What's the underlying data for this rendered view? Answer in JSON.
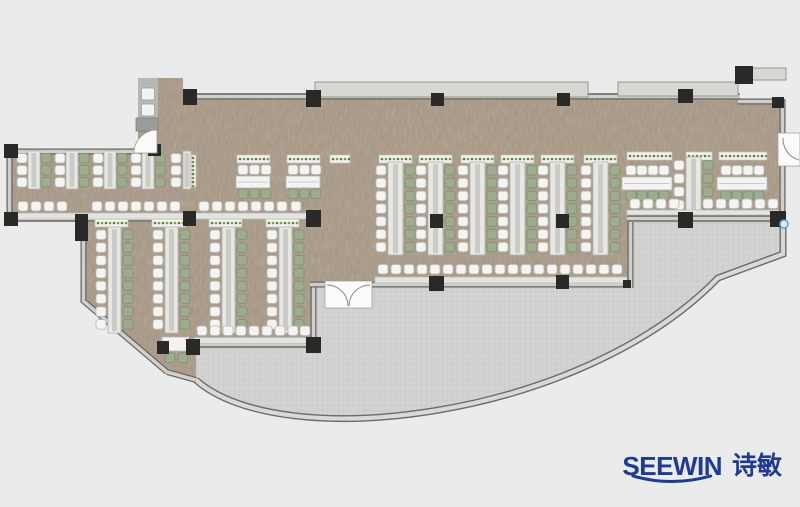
{
  "logo": {
    "brand": "SEEWIN",
    "cjk": "诗敏",
    "color": "#1b3a99"
  },
  "colors": {
    "background": "#ebebeb",
    "floor": "#a99884",
    "terrace": "#d3d3d1",
    "terrace_grid": "#c3c3c1",
    "wall_dark": "#63635f",
    "wall_light": "#cfcfcb",
    "canopy": "#d8d8d3",
    "canopy_edge": "#97978f",
    "column": "#292927",
    "bench": "#e7e7e3",
    "bench_edge": "#b5b5b1",
    "bench_spine": "#cbcbc7",
    "desk": "#f3f3f1",
    "chair_white": "#f4f4f2",
    "chair_white_edge": "#b9b9b5",
    "chair_green": "#9dac8d",
    "chair_green_edge": "#7f9070",
    "planter_bg": "#f1f1ef",
    "planter_edge": "#c2c2be",
    "planter_dot": "#5f7d37",
    "planter_dot2": "#7a9a4a",
    "counter": "#e3e3df",
    "counter_edge": "#b8b8b4",
    "door": "#fbfbf9",
    "door_edge": "#999995",
    "core_fill": "#b7b7b3",
    "core_cap": "#9c9c98",
    "curve_dark": "#6b6b67",
    "curve_light": "#d9d9d7",
    "handle_blue": "#5b9bd5",
    "handle_fill": "#dce9f5"
  },
  "plan": {
    "canvas": {
      "w": 800,
      "h": 507
    },
    "floor_path": "M158,78 L183,78 L183,93 L738,93 L738,100 L783,100 L783,222 L630,222 L630,286 L316,286 L316,348 L196,348 L196,380 L166,372 L84,302 L84,222 L10,222 L10,150 L138,150 L138,78 Z",
    "terrace_path": "M196,348 L316,348 L316,288 L630,288 L630,222 L783,222 L783,254 L718,278 C580,420 280,455 196,380 Z",
    "curve_wall_path": "M196,380 C280,455 580,420 718,278 L783,254 L783,222",
    "walls": [
      [
        183,
        96.5,
        740,
        96.5
      ],
      [
        738,
        101.5,
        784,
        101.5
      ],
      [
        782.5,
        99,
        782.5,
        136
      ],
      [
        782.5,
        163,
        782.5,
        222
      ],
      [
        8,
        151.5,
        152,
        151.5
      ],
      [
        9.5,
        148,
        9.5,
        222
      ],
      [
        8,
        218.5,
        196,
        218.5
      ],
      [
        83.5,
        222,
        83.5,
        303
      ],
      [
        83.5,
        301,
        167,
        372
      ],
      [
        167,
        372,
        196,
        380
      ],
      [
        193,
        344.5,
        316,
        344.5
      ],
      [
        313.5,
        285,
        313.5,
        348
      ],
      [
        310,
        284.5,
        326,
        284.5
      ],
      [
        371,
        284.5,
        632,
        284.5
      ],
      [
        630.5,
        222,
        630.5,
        288
      ],
      [
        627,
        218.5,
        783,
        218.5
      ]
    ],
    "canopies": [
      [
        315,
        82,
        273,
        15
      ],
      [
        618,
        82,
        120,
        14
      ],
      [
        736,
        68,
        50,
        12
      ]
    ],
    "columns": [
      [
        183,
        89,
        14,
        16
      ],
      [
        306,
        90,
        15,
        17
      ],
      [
        431,
        93,
        13,
        13
      ],
      [
        557,
        93,
        13,
        13
      ],
      [
        678,
        89,
        15,
        14
      ],
      [
        735,
        66,
        18,
        18
      ],
      [
        772,
        97,
        12,
        11
      ],
      [
        75,
        214,
        13,
        27
      ],
      [
        183,
        211,
        13,
        15
      ],
      [
        306,
        210,
        15,
        17
      ],
      [
        430,
        214,
        13,
        14
      ],
      [
        556,
        214,
        13,
        14
      ],
      [
        678,
        212,
        15,
        16
      ],
      [
        770,
        211,
        16,
        16
      ],
      [
        4,
        144,
        14,
        14
      ],
      [
        4,
        212,
        14,
        14
      ],
      [
        148,
        144,
        13,
        12
      ],
      [
        306,
        337,
        15,
        16
      ],
      [
        429,
        276,
        15,
        15
      ],
      [
        556,
        275,
        13,
        14
      ],
      [
        186,
        339,
        14,
        16
      ],
      [
        157,
        341,
        12,
        13
      ],
      [
        623,
        280,
        8,
        8
      ]
    ],
    "planters_h": [
      [
        237,
        155,
        33
      ],
      [
        287,
        155,
        33
      ],
      [
        330,
        155,
        20
      ],
      [
        379,
        155,
        33
      ],
      [
        419,
        155,
        33
      ],
      [
        461,
        155,
        33
      ],
      [
        501,
        155,
        33
      ],
      [
        541,
        155,
        33
      ],
      [
        584,
        155,
        33
      ],
      [
        95,
        219,
        33
      ],
      [
        152,
        219,
        33
      ],
      [
        209,
        219,
        33
      ],
      [
        266,
        219,
        33
      ],
      [
        627,
        152,
        45
      ],
      [
        686,
        152,
        26
      ],
      [
        719,
        152,
        48
      ]
    ],
    "planters_v": [
      [
        190,
        155,
        6,
        32
      ]
    ],
    "v_runs": [
      {
        "bench": [
          28,
          151,
          12,
          38
        ],
        "left_x": 17,
        "right_x": 41,
        "y0": 153.5,
        "pitch": 12,
        "count": 3,
        "right": "green"
      },
      {
        "bench": [
          66,
          151,
          12,
          38
        ],
        "left_x": 55,
        "right_x": 79,
        "y0": 153.5,
        "pitch": 12,
        "count": 3,
        "right": "green"
      },
      {
        "bench": [
          104,
          151,
          12,
          38
        ],
        "left_x": 93,
        "right_x": 117,
        "y0": 153.5,
        "pitch": 12,
        "count": 3,
        "right": "green"
      },
      {
        "bench": [
          142,
          151,
          12,
          38
        ],
        "left_x": 131,
        "right_x": 155,
        "y0": 153.5,
        "pitch": 12,
        "count": 3,
        "right": "green"
      },
      {
        "bench": [
          183,
          151,
          8,
          38
        ],
        "left_x": 171,
        "right_x": null,
        "y0": 153.5,
        "pitch": 12,
        "count": 3,
        "right": "none"
      },
      {
        "bench": [
          108,
          227,
          13,
          106
        ],
        "left_x": 96,
        "right_x": 123,
        "y0": 230,
        "pitch": 12.8,
        "count": 8,
        "right": "green"
      },
      {
        "bench": [
          165,
          227,
          13,
          106
        ],
        "left_x": 153,
        "right_x": 180,
        "y0": 230,
        "pitch": 12.8,
        "count": 8,
        "right": "green"
      },
      {
        "bench": [
          222,
          227,
          13,
          106
        ],
        "left_x": 210,
        "right_x": 237,
        "y0": 230,
        "pitch": 12.8,
        "count": 8,
        "right": "green"
      },
      {
        "bench": [
          279,
          227,
          13,
          106
        ],
        "left_x": 267,
        "right_x": 294,
        "y0": 230,
        "pitch": 12.8,
        "count": 8,
        "right": "green"
      },
      {
        "bench": [
          388,
          162,
          15,
          93
        ],
        "left_x": 376,
        "right_x": 405,
        "y0": 165.5,
        "pitch": 12.8,
        "count": 7,
        "right": "green"
      },
      {
        "bench": [
          428,
          162,
          15,
          93
        ],
        "left_x": 416,
        "right_x": 445,
        "y0": 165.5,
        "pitch": 12.8,
        "count": 7,
        "right": "green"
      },
      {
        "bench": [
          470,
          162,
          15,
          93
        ],
        "left_x": 458,
        "right_x": 487,
        "y0": 165.5,
        "pitch": 12.8,
        "count": 7,
        "right": "green"
      },
      {
        "bench": [
          510,
          162,
          15,
          93
        ],
        "left_x": 498,
        "right_x": 527,
        "y0": 165.5,
        "pitch": 12.8,
        "count": 7,
        "right": "green"
      },
      {
        "bench": [
          550,
          162,
          15,
          93
        ],
        "left_x": 538,
        "right_x": 567,
        "y0": 165.5,
        "pitch": 12.8,
        "count": 7,
        "right": "green"
      },
      {
        "bench": [
          593,
          162,
          15,
          93
        ],
        "left_x": 581,
        "right_x": 610,
        "y0": 165.5,
        "pitch": 12.8,
        "count": 7,
        "right": "green"
      },
      {
        "bench": [
          686,
          157,
          15,
          58
        ],
        "left_x": 674,
        "right_x": 703,
        "y0": 160.5,
        "pitch": 13.2,
        "count": 4,
        "right": "green"
      }
    ],
    "h_clusters": [
      {
        "desk": [
          236,
          176,
          34,
          12
        ],
        "xs": [
          238,
          249.5,
          261
        ],
        "top_y": 165,
        "bot_y": 189
      },
      {
        "desk": [
          286,
          176,
          34,
          12
        ],
        "xs": [
          288,
          299.5,
          311
        ],
        "top_y": 165,
        "bot_y": 189
      },
      {
        "desk": [
          622,
          177,
          50,
          13
        ],
        "xs": [
          626,
          637,
          648,
          659
        ],
        "top_y": 165.5,
        "bot_y": 191
      },
      {
        "desk": [
          717,
          177,
          50,
          13
        ],
        "xs": [
          721,
          732,
          743,
          754
        ],
        "top_y": 165.5,
        "bot_y": 191
      }
    ],
    "counters": [
      {
        "rect": [
          12,
          213,
          296,
          6
        ],
        "chair_y": 201.5,
        "xs": [
          18,
          31,
          44,
          57,
          92,
          105,
          118,
          131,
          144,
          157,
          170,
          199,
          212,
          225,
          238,
          251,
          264,
          277,
          291
        ]
      },
      {
        "rect": [
          194,
          337.5,
          118,
          6
        ],
        "chair_y": 326,
        "xs": [
          197,
          210,
          223,
          236,
          249,
          262,
          275,
          288,
          300
        ]
      },
      {
        "rect": [
          375,
          277,
          252,
          6
        ],
        "chair_y": 264.5,
        "xs": [
          378,
          391,
          404,
          417,
          430,
          443,
          456,
          469,
          482,
          495,
          508,
          521,
          534,
          547,
          560,
          573,
          586,
          599,
          612
        ]
      },
      {
        "rect": [
          627,
          210,
          152,
          5
        ],
        "chair_y": 199,
        "xs": [
          630,
          643,
          656,
          669,
          703,
          716,
          729,
          742,
          755,
          768
        ]
      }
    ],
    "corner_table": {
      "rect": [
        162,
        337,
        27,
        14
      ],
      "chairs": [
        [
          165,
          353
        ],
        [
          178,
          353
        ]
      ]
    },
    "core": {
      "rect": [
        138,
        78,
        20,
        46
      ],
      "panels": [
        [
          141.5,
          88,
          13,
          12
        ],
        [
          141.5,
          104,
          13,
          12
        ]
      ],
      "cap": [
        136,
        118,
        22,
        13
      ]
    },
    "doors": {
      "core_arc": "M157,130 A23,23 0 0 0 134,153 L157,153 Z",
      "double_rect": [
        325,
        281,
        47,
        27
      ],
      "double_arcs": [
        "M327,285 A21,21 0 0 1 348,306",
        "M370,285 A21,21 0 0 0 349,306"
      ],
      "right_rect": [
        778,
        133,
        22,
        33
      ],
      "right_arc": "M783,138 A22,22 0 0 0 799,160"
    },
    "handle": {
      "cx": 784,
      "cy": 224,
      "r": 4
    }
  }
}
